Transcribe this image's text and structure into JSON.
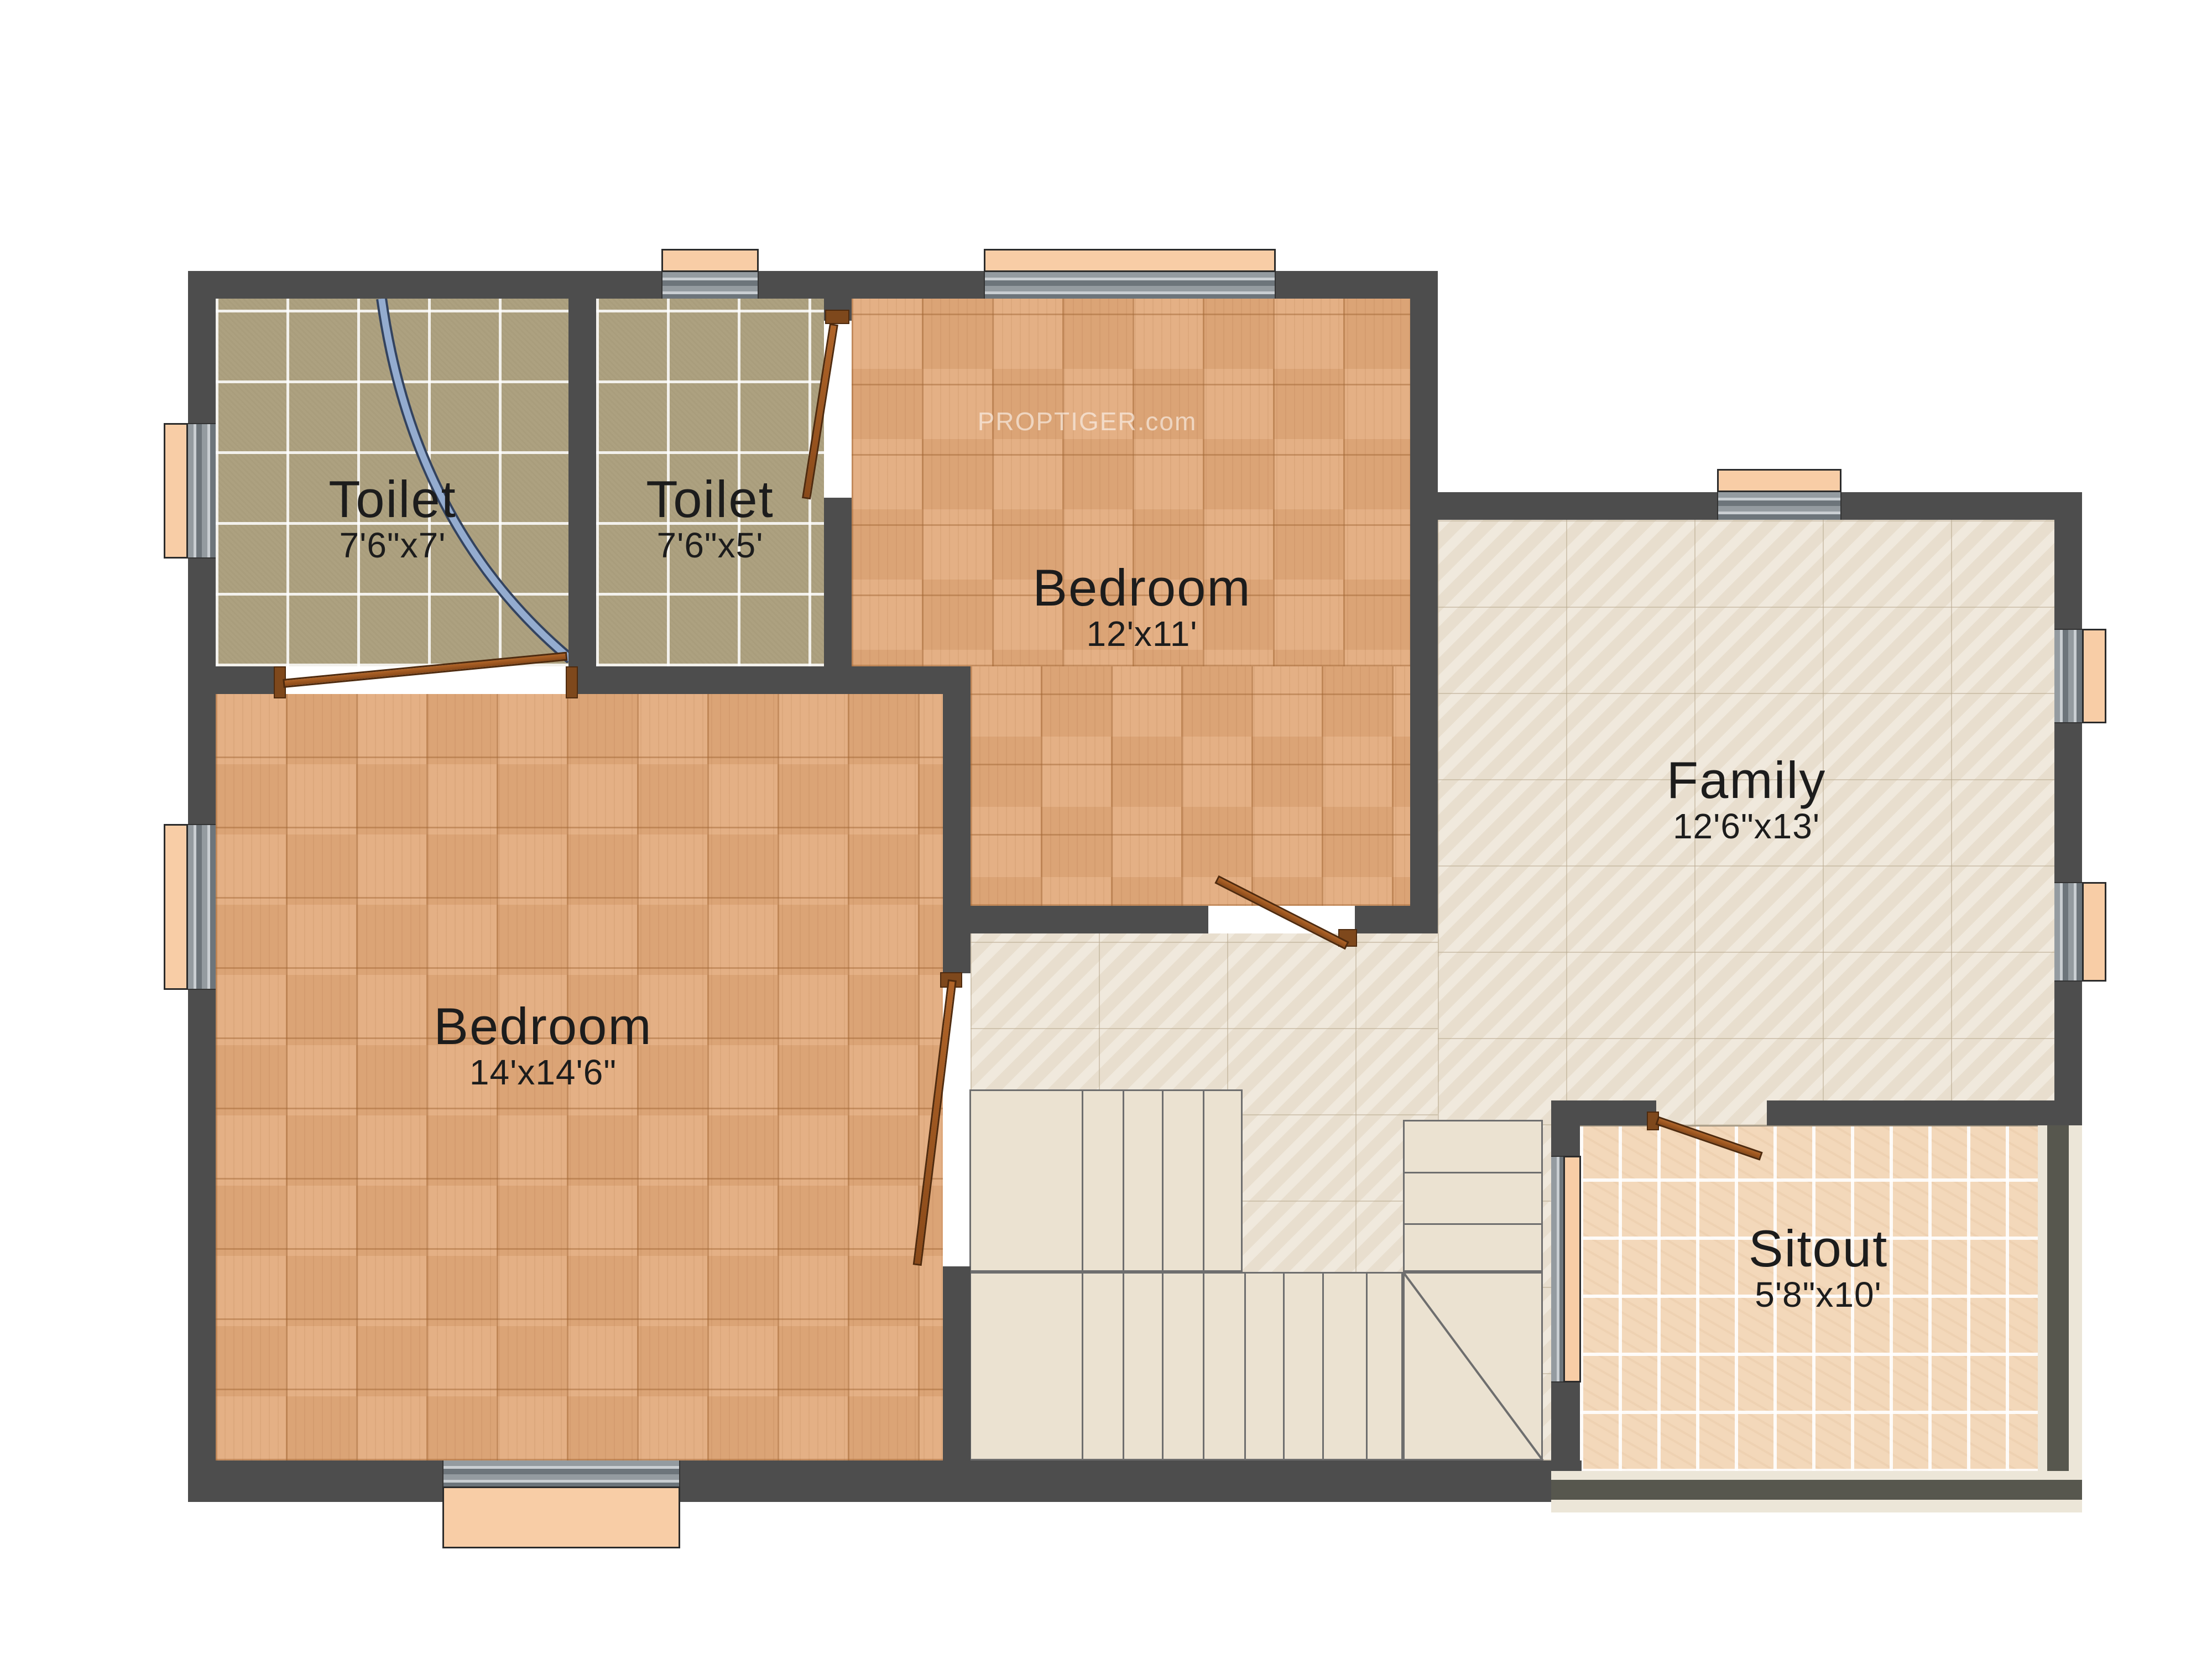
{
  "watermark": "PROPTIGER.com",
  "rooms": {
    "toilet_1": {
      "name": "Toilet",
      "dims": "7'6\"x7'"
    },
    "toilet_2": {
      "name": "Toilet",
      "dims": "7'6\"x5'"
    },
    "bedroom_top": {
      "name": "Bedroom",
      "dims": "12'x11'"
    },
    "family": {
      "name": "Family",
      "dims": "12'6\"x13'"
    },
    "bedroom_bottom": {
      "name": "Bedroom",
      "dims": "14'x14'6\""
    },
    "sitout": {
      "name": "Sitout",
      "dims": "5'8\"x10'"
    }
  },
  "colors": {
    "wall": "#4d4d4d",
    "toilet_floor": "#ada180",
    "wood_floor": "#e2ab7d",
    "family_floor": "#ebe2d2",
    "sitout_floor": "#f3d8ba",
    "window_panel": "#f8cda6",
    "door": "#a3571f",
    "shower_curtain": "#94accf",
    "stair_fill": "#ebe2d1"
  }
}
